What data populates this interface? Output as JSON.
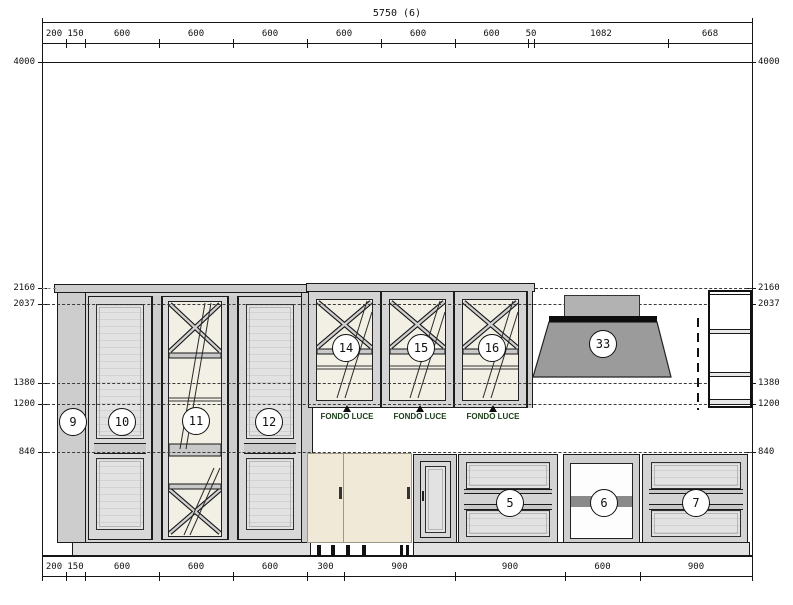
{
  "drawing": {
    "total_width_label": "5750 (6)",
    "top_segments": [
      "200",
      "150",
      "600",
      "600",
      "600",
      "600",
      "600",
      "600",
      "50",
      "1082",
      "668"
    ],
    "bottom_segments": [
      "200",
      "150",
      "600",
      "600",
      "600",
      "300",
      "900",
      "900",
      "600",
      "900"
    ],
    "left_heights": [
      "4000",
      "2160",
      "2037",
      "1380",
      "1200",
      "840"
    ],
    "right_heights": [
      "4000",
      "2160",
      "2037",
      "1380",
      "1200",
      "840"
    ],
    "callouts": {
      "c5": "5",
      "c6": "6",
      "c7": "7",
      "c9": "9",
      "c10": "10",
      "c11": "11",
      "c12": "12",
      "c14": "14",
      "c15": "15",
      "c16": "16",
      "c33": "33"
    },
    "fondo_luce_label": "FONDO LUCE",
    "colors": {
      "cabinet_gray": "#d4d4d4",
      "glass_cream": "#f2efe4",
      "hood_gray": "#9b9b9b",
      "hood_band_black": "#0d0d0d",
      "cream_door": "#f0e9d8",
      "open_unit_band": "#8a8a8a",
      "annotation_green": "#1a3d1a"
    }
  }
}
